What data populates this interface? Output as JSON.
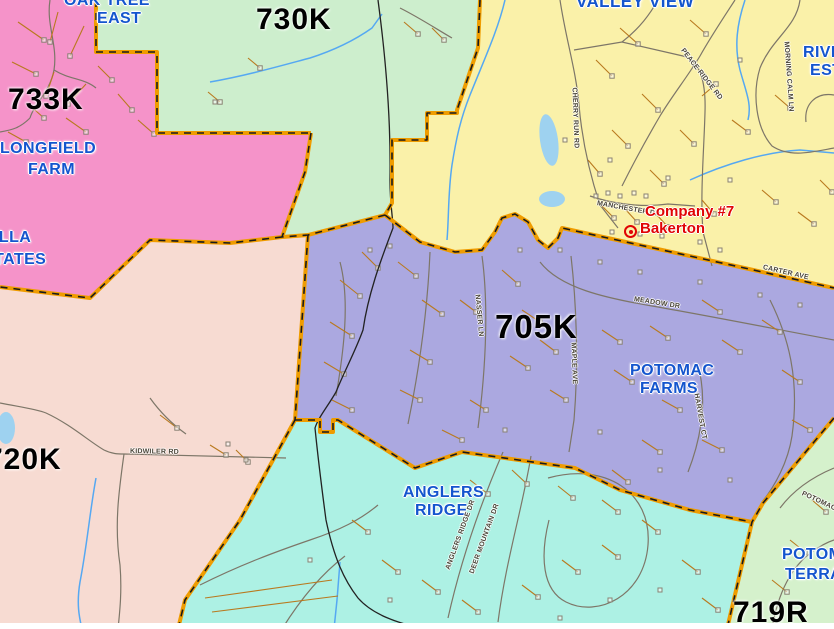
{
  "map": {
    "title": "Fire district map - Bakerton area",
    "region_colors": {
      "pink_733k": "#F593C9",
      "green_730k": "#CDEECD",
      "yellow_valley": "#FAF1A9",
      "purple_705k": "#ABA8E0",
      "salmon_720k": "#F7DBD2",
      "cyan_anglers": "#ADF1E4",
      "green_719r": "#D5F1CC"
    },
    "colors": {
      "boundary": "#EF9C00",
      "boundary_dash": "#1a1a1a",
      "county_line": "#222222",
      "water": "#55A8F2",
      "pond_fill": "#9ED2F0",
      "road": "#7D7668",
      "driveway": "#B9791E",
      "building": "#8A8274",
      "place_label": "#1455CE",
      "zone_label": "#000000",
      "station_label": "#E00505"
    },
    "zones": [
      {
        "code": "733K"
      },
      {
        "code": "730K"
      },
      {
        "code": "705K"
      },
      {
        "code": "720K"
      },
      {
        "code": "719R"
      }
    ],
    "places": {
      "oak_tree_east": {
        "line1": "OAK TREE",
        "line2": "EAST"
      },
      "valley_view": {
        "line1": "VALLEY VIEW"
      },
      "river_estates": {
        "line1": "RIVER",
        "line2": "ESTATES"
      },
      "longfield_farm": {
        "line1": "LONGFIELD",
        "line2": "FARM"
      },
      "villa_estates": {
        "line1": "VILLA",
        "line2": "ESTATES"
      },
      "potomac_farms": {
        "line1": "POTOMAC",
        "line2": "FARMS"
      },
      "anglers_ridge": {
        "line1": "ANGLERS",
        "line2": "RIDGE"
      },
      "potomac_terrace": {
        "line1": "POTOMAC",
        "line2": "TERRACE"
      }
    },
    "roads": {
      "cherry_run": "CHERRY RUN RD",
      "peace_ridge": "PEACE RIDGE RD",
      "morning_calm": "MORNING CALM LN",
      "carter": "CARTER AVE",
      "manchester": "MANCHESTER DR",
      "meadow": "MEADOW DR",
      "maple": "MAPLE AVE",
      "nasser": "NASSER LN",
      "harvest": "HARVEST CT",
      "kidwiler": "KIDWILER RD",
      "anglers_dr": "ANGLERS RIDGE DR",
      "deer_mountain": "DEER MOUNTAIN DR",
      "potomac_rd": "POTOMAC"
    },
    "station": {
      "name": "Company #7",
      "location": "Bakerton"
    }
  }
}
